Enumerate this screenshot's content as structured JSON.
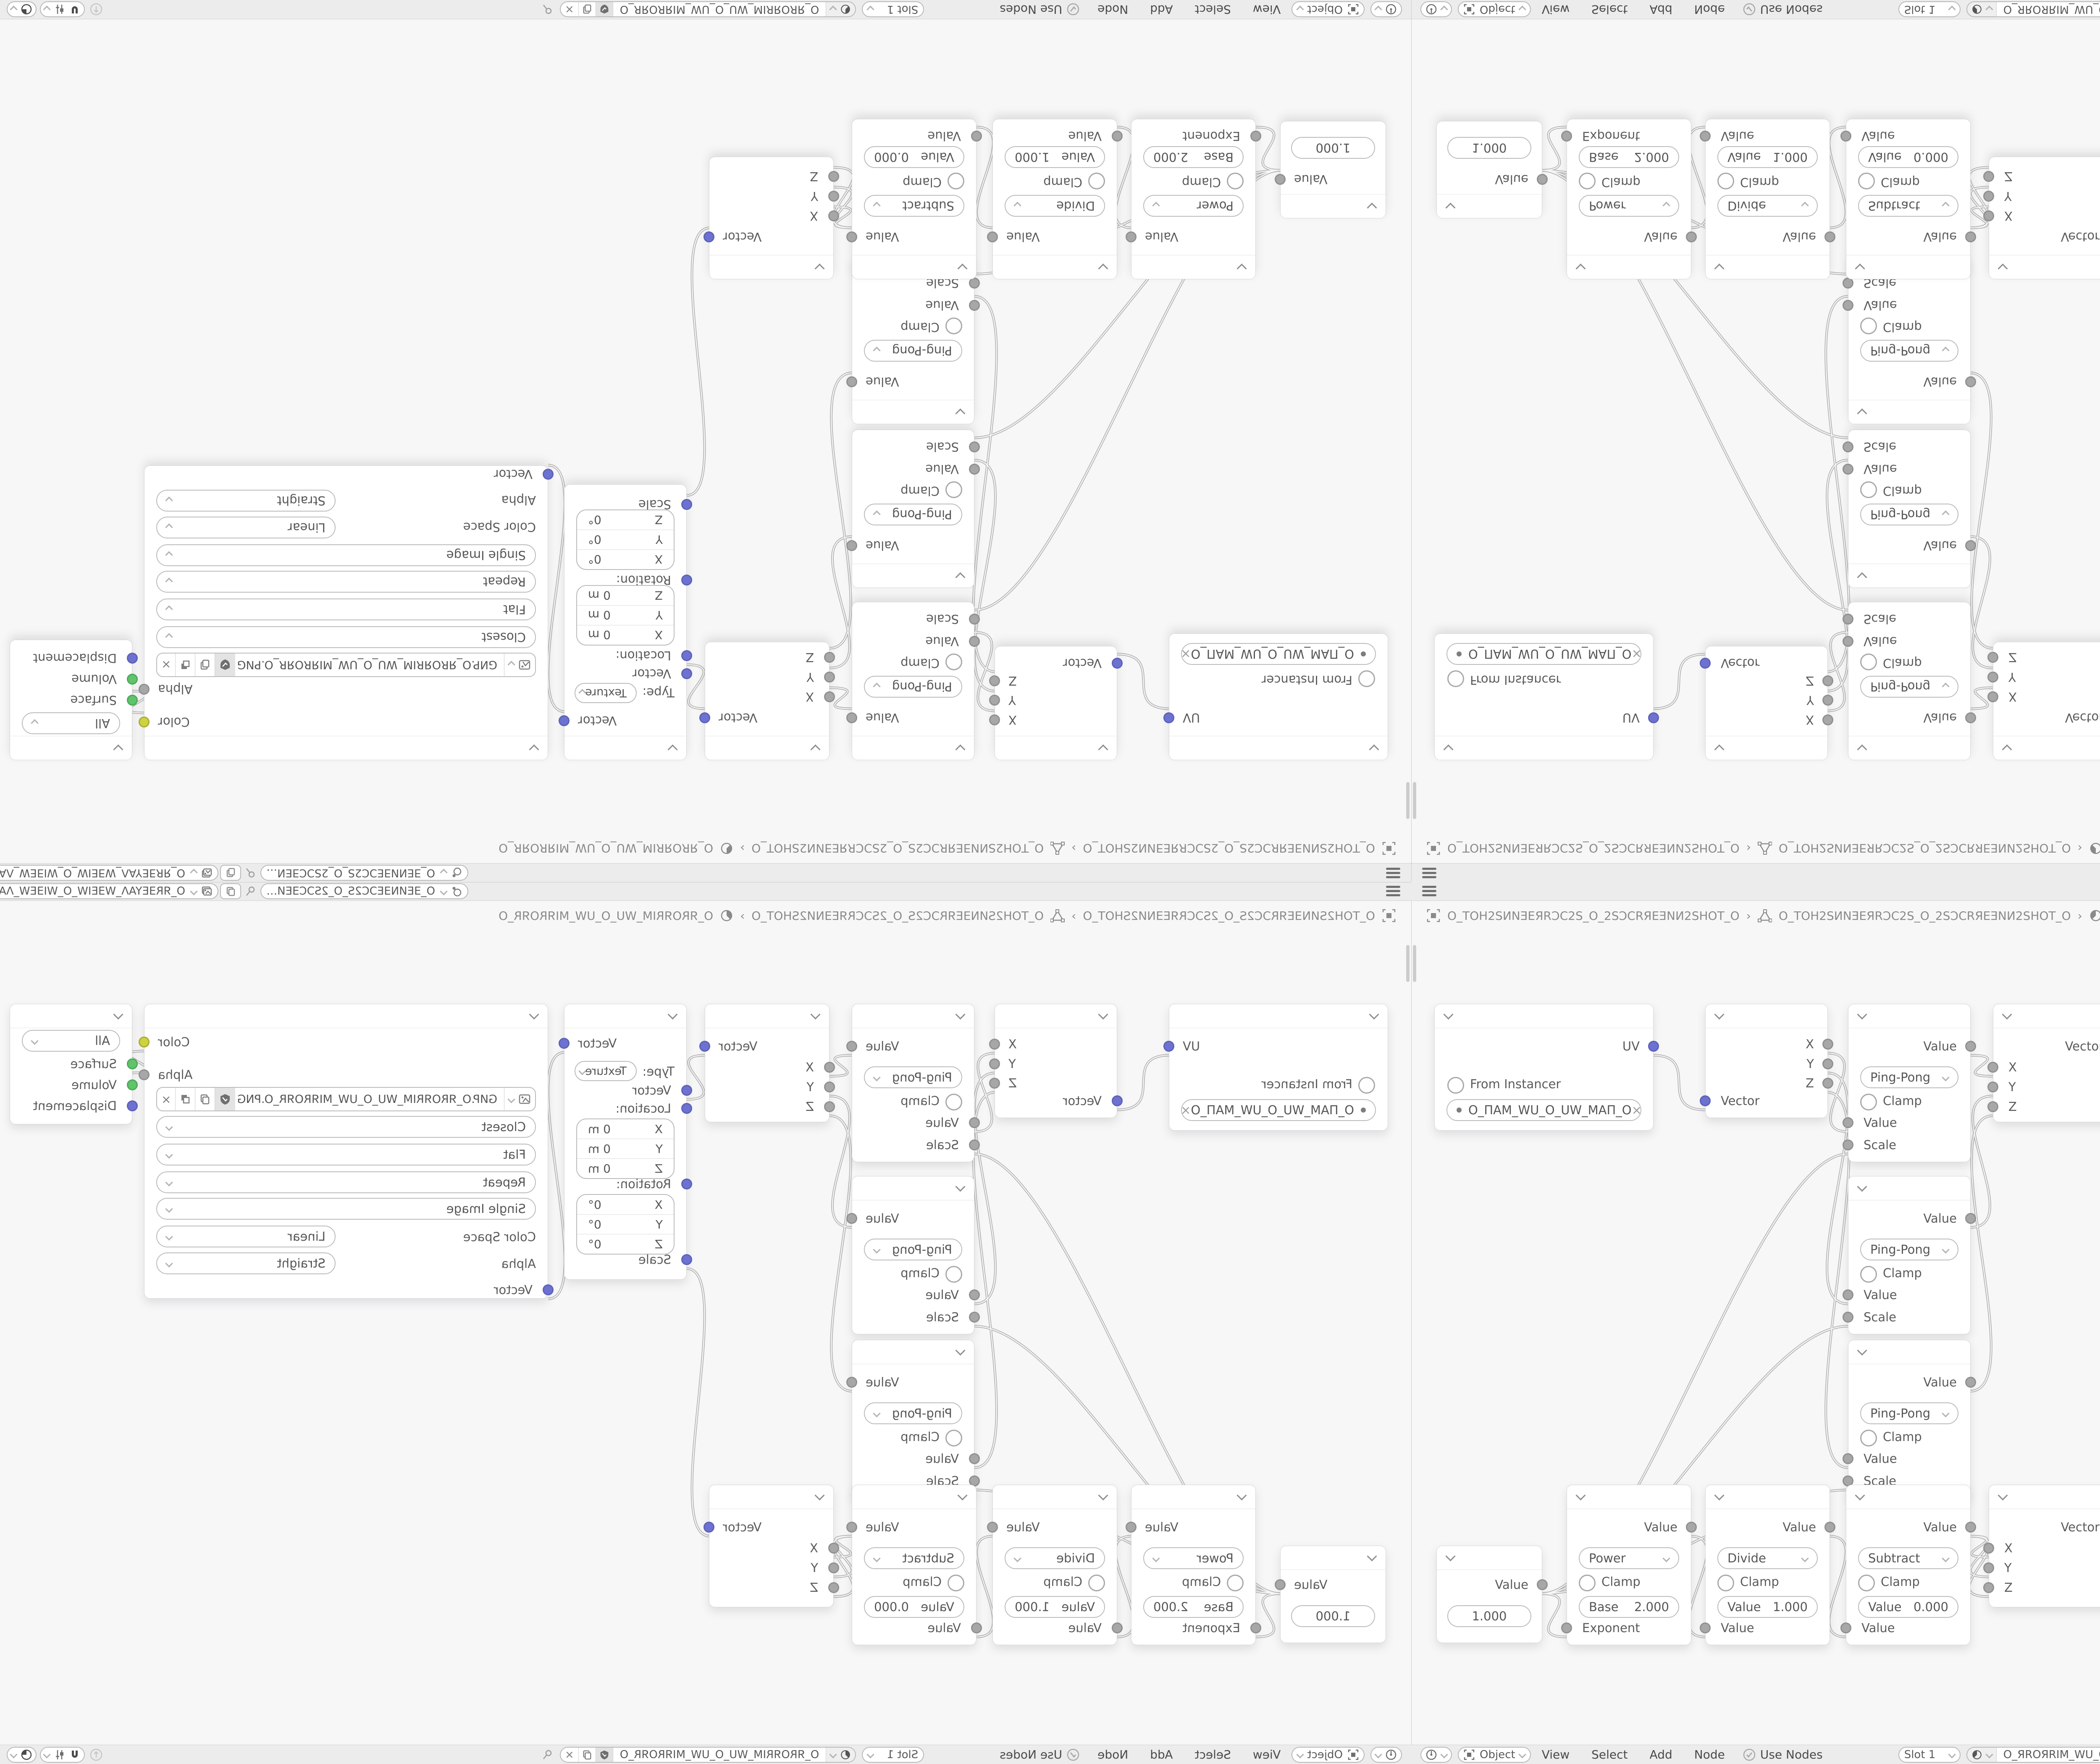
{
  "topbar": {
    "scene_name": "O_ƎEИNƎEƆC2S_O_2SƆCƎEИ…",
    "view_layer_name": "O_ЯRƎEYAΛ_WƎEIW_O_WIƎEW_ΛAYƎEЯR_O"
  },
  "breadcrumb": {
    "separator": "›",
    "object_name": "O_TOH2SИNƎEЯRƆC2S_O_2SƆCRЯEƎNИ2SHOT_O",
    "data_name": "O_TOH2SИNƎEЯRƆC2S_O_2SƆCRЯEƎNИ2SHOT_O",
    "material_name": "O_ЯROЯRIM_WU_O_UW_MIЯROЯR_O"
  },
  "footer": {
    "mode": "Object",
    "menu_view": "View",
    "menu_select": "Select",
    "menu_add": "Add",
    "menu_node": "Node",
    "use_nodes": "Use Nodes",
    "slot": "Slot 1",
    "material_name": "O_ЯROЯRIM_WU_O_UW_MIЯROЯR_O"
  },
  "nodes": {
    "uvmap": {
      "uv_out": "UV",
      "from_instancer": "From Instancer",
      "uv_name": "O_ПAM_WU_O_UW_MAП_O",
      "clear": "×"
    },
    "sepxyz": {
      "x": "X",
      "y": "Y",
      "z": "Z",
      "vector_in": "Vector"
    },
    "pingpong": [
      {
        "out": "Value",
        "op": "Ping-Pong",
        "clamp": "Clamp",
        "value_in": "Value",
        "scale_in": "Scale"
      },
      {
        "out": "Value",
        "op": "Ping-Pong",
        "clamp": "Clamp",
        "value_in": "Value",
        "scale_in": "Scale"
      },
      {
        "out": "Value",
        "op": "Ping-Pong",
        "clamp": "Clamp",
        "value_in": "Value",
        "scale_in": "Scale"
      }
    ],
    "combine_top": {
      "vector_out": "Vector",
      "x": "X",
      "y": "Y",
      "z": "Z"
    },
    "mapping": {
      "vector_out": "Vector",
      "type_label": "Type:",
      "type_value": "Texture",
      "vector_in": "Vector",
      "location": "Location:",
      "rotation": "Rotation:",
      "scale": "Scale",
      "ax": "X",
      "ay": "Y",
      "az": "Z",
      "loc_value": "0 m",
      "rot_value": "0°"
    },
    "image": {
      "color_out": "Color",
      "alpha_out": "Alpha",
      "filename": "GИP.O_ЯROЯRIM_WU_O_UW_MIЯROЯR_O.PNG",
      "interpolation": "Closest",
      "projection": "Flat",
      "extension": "Repeat",
      "source": "Single Image",
      "color_space_label": "Color Space",
      "color_space": "Linear",
      "alpha_label": "Alpha",
      "alpha_mode": "Straight",
      "vector_in": "Vector"
    },
    "output": {
      "target": "All",
      "surface": "Surface",
      "volume": "Volume",
      "displacement": "Displacement"
    },
    "value": {
      "out": "Value",
      "value": "1.000"
    },
    "power": {
      "out": "Value",
      "op": "Power",
      "clamp": "Clamp",
      "f_label": "Base",
      "f_value": "2.000",
      "in2": "Exponent"
    },
    "divide": {
      "out": "Value",
      "op": "Divide",
      "clamp": "Clamp",
      "f_label": "Value",
      "f_value": "1.000",
      "in2": "Value"
    },
    "subtract": {
      "out": "Value",
      "op": "Subtract",
      "clamp": "Clamp",
      "f_label": "Value",
      "f_value": "0.000",
      "in2": "Value"
    },
    "combine_bottom": {
      "vector_out": "Vector",
      "x": "X",
      "y": "Y",
      "z": "Z"
    }
  }
}
